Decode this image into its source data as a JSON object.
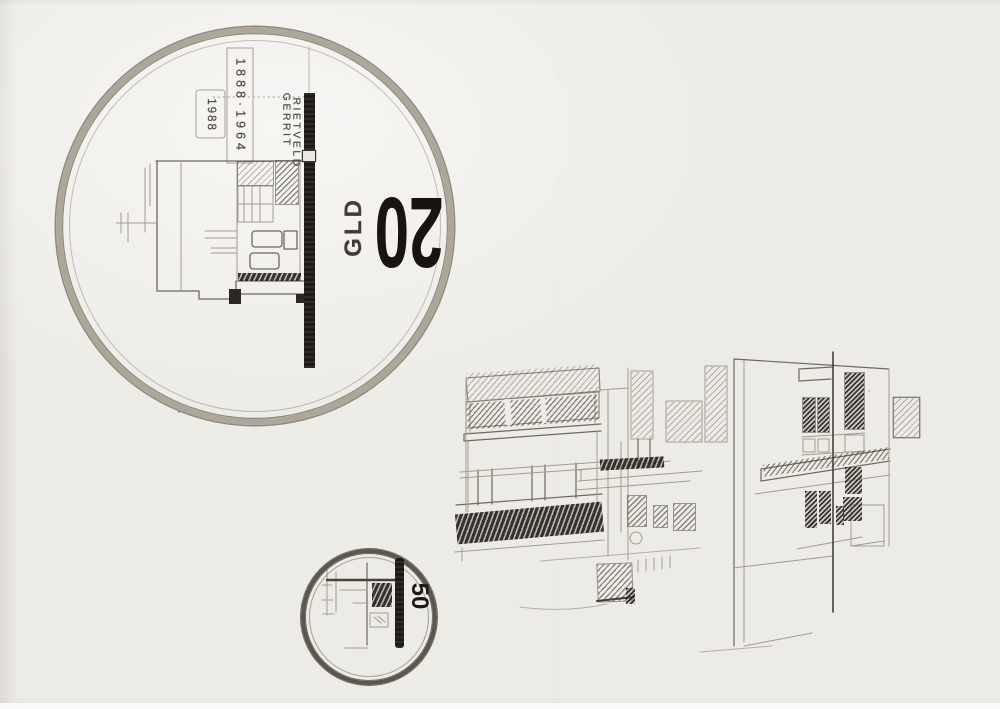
{
  "artwork": {
    "type": "pencil sketch, coin design study with building perspective",
    "colors": {
      "paper": "#edebe6",
      "pencil_light": "#a19c91",
      "pencil_medium": "#756f65",
      "pencil_dark": "#3f3b34",
      "graphite_black": "#1d1a16",
      "rim_shade": "#ada79a"
    }
  },
  "large_coin": {
    "name_first": "GERRIT",
    "name_last": "RIETVELD",
    "life_years": "1888·1964",
    "issue_year": "1988",
    "denomination": "20",
    "currency": "GLD"
  },
  "small_coin": {
    "denomination": "50"
  }
}
